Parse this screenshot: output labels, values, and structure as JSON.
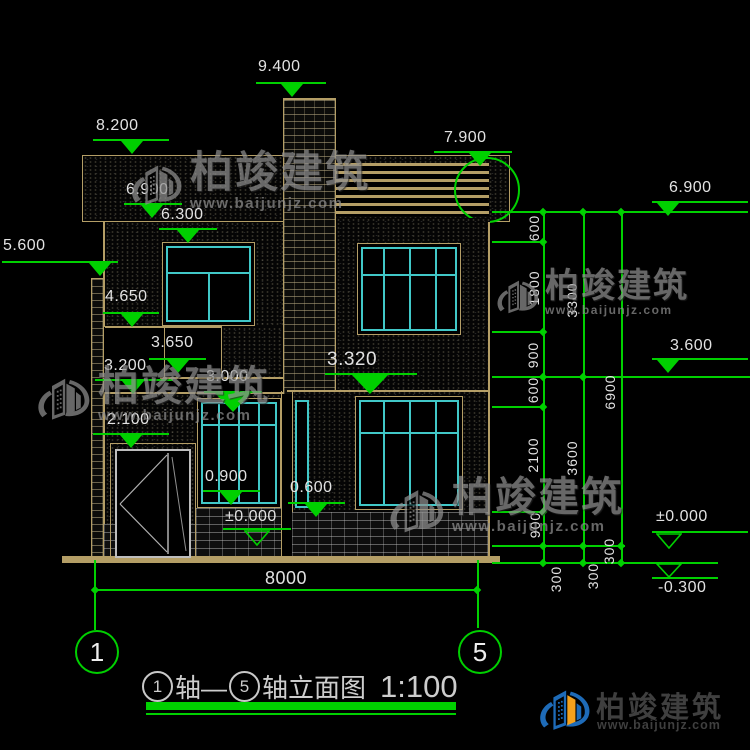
{
  "colors": {
    "green": "#00d000",
    "tan": "#b49e66",
    "cyan": "#41c8c8",
    "white": "#e2e2e2",
    "brand_blue": "#1e6bb8",
    "brand_orange": "#f5a11c"
  },
  "brand": {
    "name": "柏竣建筑",
    "url": "www.baijunjz.com"
  },
  "title": {
    "axis_left": "1",
    "mid": "轴—",
    "axis_right": "5",
    "suffix": "轴立面图",
    "scale": "1:100"
  },
  "axis_bubbles": {
    "left": "1",
    "right": "5"
  },
  "markers": {
    "m9400": "9.400",
    "m8200": "8.200",
    "m6900_left": "6.900",
    "m6300": "6.300",
    "m5600": "5.600",
    "m4650": "4.650",
    "m3650": "3.650",
    "m3200": "3.200",
    "m3000": "3.000",
    "m3320": "3.320",
    "m2100": "2.100",
    "m0900": "0.900",
    "m0600": "0.600",
    "m0000_left": "±0.000",
    "m7900": "7.900",
    "m6900_right": "6.900",
    "m3600_right": "3.600",
    "m0000_right": "±0.000",
    "mneg0300": "-0.300"
  },
  "dimensions": {
    "v600a": "600",
    "v1800": "1800",
    "v900a": "900",
    "v600b": "600",
    "v2100": "2100",
    "v900b": "900",
    "v300a": "300",
    "v3300": "3300",
    "v3600": "3600",
    "v300b": "300",
    "v6900": "6900",
    "v300c": "300",
    "h8000": "8000"
  }
}
